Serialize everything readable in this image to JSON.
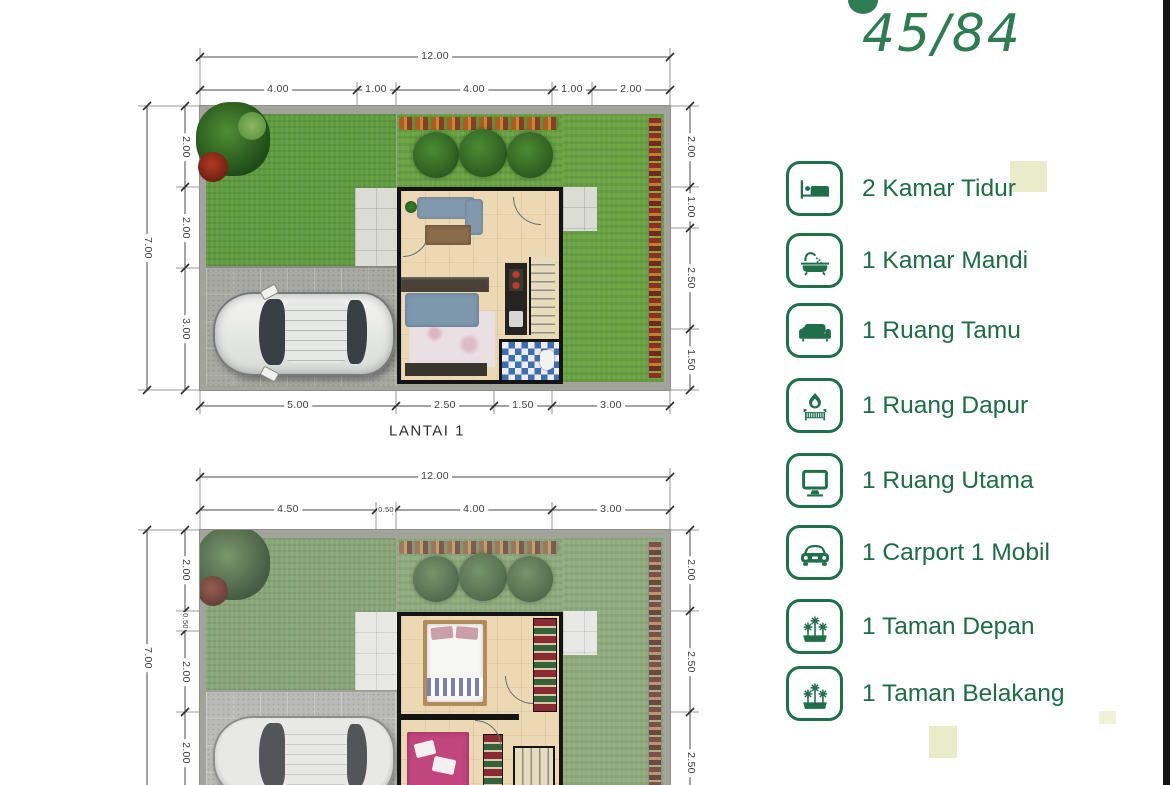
{
  "header": {
    "type_label": "45/84"
  },
  "legend": {
    "accent_color": "#1e6f4a",
    "items": [
      {
        "icon": "bed-icon",
        "label": "2 Kamar Tidur"
      },
      {
        "icon": "bathtub-icon",
        "label": "1 Kamar Mandi"
      },
      {
        "icon": "sofa-icon",
        "label": "1 Ruang Tamu"
      },
      {
        "icon": "stove-icon",
        "label": "1 Ruang Dapur"
      },
      {
        "icon": "monitor-icon",
        "label": "1 Ruang Utama"
      },
      {
        "icon": "car-icon",
        "label": "1 Carport 1 Mobil"
      },
      {
        "icon": "garden-icon",
        "label": "1 Taman Depan"
      },
      {
        "icon": "garden-icon",
        "label": "1 Taman Belakang"
      }
    ]
  },
  "plans": [
    {
      "name": "LANTAI 1",
      "dims": {
        "top_total": "12.00",
        "top_segments": [
          "4.00",
          "1.00",
          "4.00",
          "1.00",
          "2.00"
        ],
        "left_total": "7.00",
        "left_segments": [
          "2.00",
          "2.00",
          "3.00"
        ],
        "right_segments": [
          "2.00",
          "1.00",
          "2.50",
          "1.50"
        ],
        "bottom_segments": [
          "5.00",
          "2.50",
          "1.50",
          "3.00"
        ]
      }
    },
    {
      "dims": {
        "top_total": "12.00",
        "top_segments": [
          "4.50",
          "0.50",
          "4.00",
          "3.00"
        ],
        "left_total": "7.00",
        "left_segments": [
          "2.00",
          "0.50",
          "2.00",
          "2.00"
        ],
        "right_segments": [
          "2.00",
          "2.50",
          "2.50"
        ]
      }
    }
  ],
  "colors": {
    "accent_green": "#1e6f4a",
    "dim_line": "#4a4a4a",
    "grass": "#5e9c3f",
    "pale_square": "#e8ecc8"
  }
}
